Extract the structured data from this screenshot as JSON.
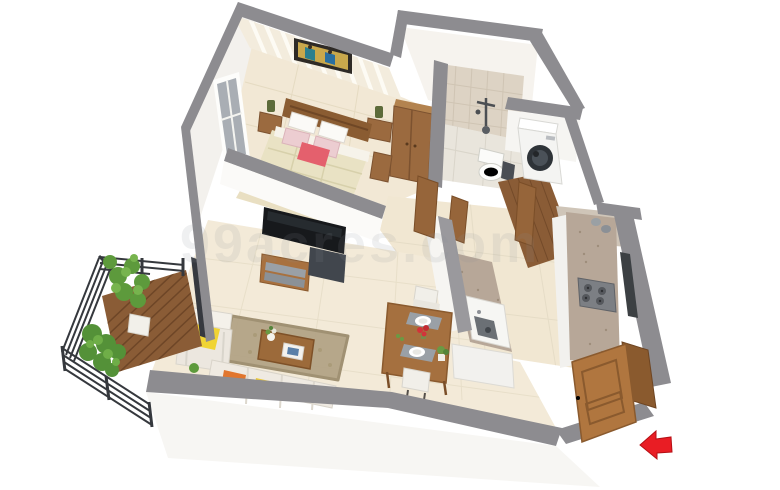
{
  "scene": {
    "type": "3d-floor-plan-render",
    "style": "isometric perspective photorealistic render of a 1BHK apartment on white background",
    "watermark": "99acres.com",
    "background_color": "#ffffff"
  },
  "entrance": {
    "arrow_color": "#e91d24",
    "arrow_direction": "left",
    "door": "open wooden panel door at bottom-right entrance"
  },
  "palette": {
    "wall_cap_grey": "#8d8c90",
    "wall_face_white": "#faf9f7",
    "floor_beige": "#f1e7d2",
    "wallpaper_cream": "#f3ecdd",
    "wood_brown": "#9b6a3f",
    "dark_wood": "#8a5c32",
    "deck_brown": "#8a5c36",
    "granite_speckle": "#b7a798",
    "bath_tile": "#ddd3c4",
    "rug_taupe": "#b3a486",
    "accent_pink_pillow": "#e4606d",
    "floral_pillow_pink": "#eccdd1",
    "accent_yellow": "#f0d433",
    "accent_orange": "#e1762e",
    "plant_green": "#6a9a44",
    "tv_black": "#17191c",
    "washer_white": "#f4f4f2"
  },
  "rooms": {
    "bedroom": {
      "name": "bedroom",
      "position": "top-left",
      "features": [
        "cream striped wallpaper",
        "framed wall art with figures",
        "window in left wall",
        "wooden double bed",
        "two white pillows",
        "two pink floral pillows",
        "coral accent pillow",
        "quilted cream blanket",
        "left nightstand with lamp",
        "right nightstand with lamp",
        "wooden wardrobe",
        "beige rug",
        "open wooden door"
      ]
    },
    "bathroom": {
      "name": "bathroom",
      "position": "top-center",
      "features": [
        "beige square wall tiles",
        "shower mixer",
        "white toilet",
        "grey floor tiles",
        "open wooden door"
      ]
    },
    "utility": {
      "name": "utility / dry balcony",
      "position": "top-right",
      "features": [
        "front-load washing machine",
        "wooden plank floor",
        "pebble-floor wash alcove",
        "two grey buckets",
        "open wooden door"
      ]
    },
    "kitchen": {
      "name": "kitchen",
      "position": "right",
      "features": [
        "granite wall counter with 4-burner gas hob",
        "two grey jars",
        "window strip in right wall",
        "granite peninsula counter with stainless sink",
        "white cabinet bases",
        "beige tiled floor"
      ]
    },
    "dining": {
      "name": "dining area",
      "position": "center-bottom",
      "features": [
        "square wooden table",
        "two white chairs",
        "two grey placemats with white plates",
        "red flower centerpiece",
        "small potted plant"
      ]
    },
    "living": {
      "name": "living room",
      "position": "bottom-left-center",
      "features": [
        "wall-mounted black TV on partition",
        "wooden TV console with grey drawers",
        "dark AV unit",
        "white armchair with yellow pillow",
        "taupe shag rug",
        "wooden coffee table with vase and framed tray",
        "white sofa with orange and yellow pillows",
        "small green plant",
        "large beige floor tiles"
      ]
    },
    "balcony": {
      "name": "balcony",
      "position": "bottom-left",
      "features": [
        "wooden deck planks",
        "dark metal horizontal-bar railing",
        "tall potted plant in white planter",
        "corner bush plant",
        "dark sliding-door frame"
      ]
    }
  }
}
